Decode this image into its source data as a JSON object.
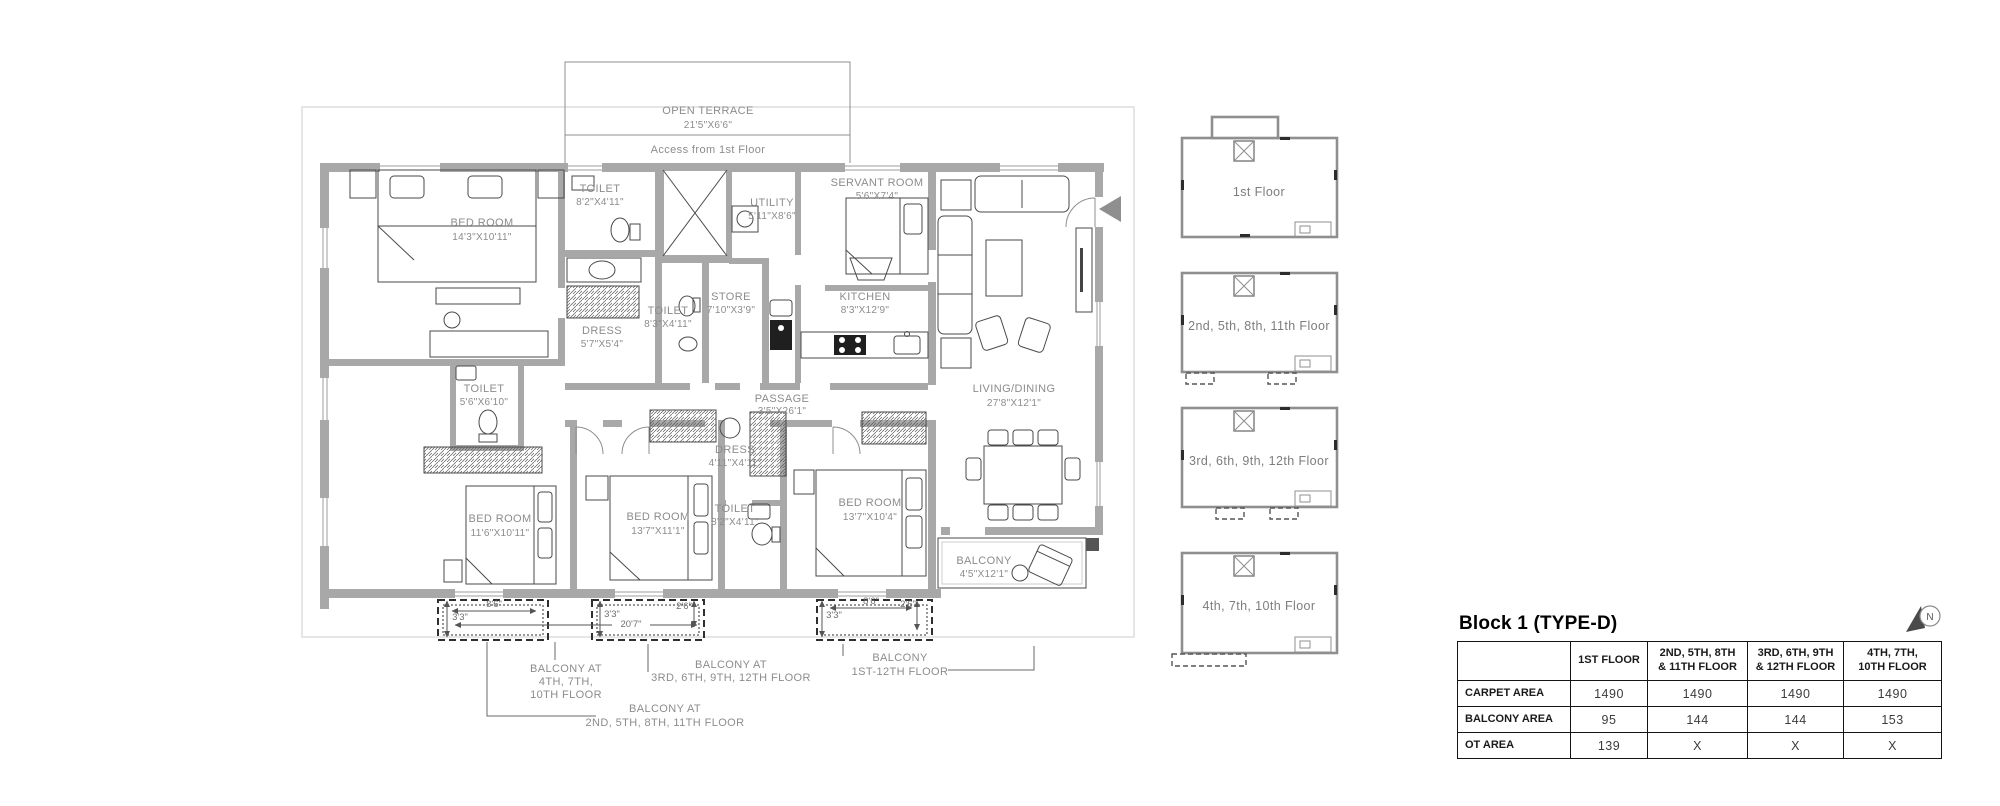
{
  "plan": {
    "open_terrace": {
      "name": "OPEN TERRACE",
      "size": "21'5\"X6'6\""
    },
    "access_note": "Access from 1st Floor",
    "rooms": {
      "bedroom1": {
        "name": "BED ROOM",
        "size": "14'3\"X10'11\""
      },
      "toilet_top": {
        "name": "TOILET",
        "size": "8'2\"X4'11\""
      },
      "utility": {
        "name": "UTILITY",
        "size": "5'11\"X8'6\""
      },
      "servant": {
        "name": "SERVANT ROOM",
        "size": "5'6\"X7'4\""
      },
      "store": {
        "name": "STORE",
        "size": "7'10\"X3'9\""
      },
      "toilet_mid": {
        "name": "TOILET",
        "size": "8'3\"X4'11\""
      },
      "kitchen": {
        "name": "KITCHEN",
        "size": "8'3\"X12'9\""
      },
      "dress1": {
        "name": "DRESS",
        "size": "5'7\"X5'4\""
      },
      "toilet_left": {
        "name": "TOILET",
        "size": "5'6\"X6'10\""
      },
      "passage": {
        "name": "PASSAGE",
        "size": "3'5\"X26'1\""
      },
      "living": {
        "name": "LIVING/DINING",
        "size": "27'8\"X12'1\""
      },
      "dress2": {
        "name": "DRESS",
        "size": "4'11\"X4'11\""
      },
      "toilet_bottom": {
        "name": "TOILET",
        "size": "8'2\"X4'11\""
      },
      "bedroom2": {
        "name": "BED ROOM",
        "size": "11'6\"X10'11\""
      },
      "bedroom3": {
        "name": "BED ROOM",
        "size": "13'7\"X11'1\""
      },
      "bedroom4": {
        "name": "BED ROOM",
        "size": "13'7\"X10'4\""
      },
      "balcony": {
        "name": "BALCONY",
        "size": "4'5\"X12'1\""
      }
    },
    "dims": {
      "b1_w": "8'6\"",
      "b1_d": "3'3\"",
      "b2_d": "3'3\"",
      "b2_w": "20'7\"",
      "b2_e": "2'6\"",
      "b3_w": "8'6\"",
      "b3_d": "3'3\"",
      "b3_e": "2'6\""
    },
    "notes": {
      "n1": {
        "l1": "BALCONY AT",
        "l2": "4TH, 7TH,",
        "l3": "10TH FLOOR"
      },
      "n2": {
        "l1": "BALCONY AT",
        "l2": "3RD, 6TH, 9TH, 12TH FLOOR"
      },
      "n3": {
        "l1": "BALCONY AT",
        "l2": "2ND, 5TH, 8TH, 11TH FLOOR"
      },
      "n4": {
        "l1": "BALCONY",
        "l2": "1ST-12TH FLOOR"
      }
    }
  },
  "key_plans": [
    {
      "label": "1st Floor"
    },
    {
      "label": "2nd, 5th, 8th, 11th Floor"
    },
    {
      "label": "3rd, 6th, 9th, 12th Floor"
    },
    {
      "label": "4th, 7th, 10th Floor"
    }
  ],
  "compass": {
    "label": "N"
  },
  "table": {
    "title": "Block 1 (TYPE-D)",
    "columns": [
      "1ST FLOOR",
      "2ND, 5TH, 8TH\n& 11TH FLOOR",
      "3RD, 6TH, 9TH\n& 12TH FLOOR",
      "4TH, 7TH,\n10TH FLOOR"
    ],
    "rows": [
      {
        "label": "CARPET AREA",
        "values": [
          "1490",
          "1490",
          "1490",
          "1490"
        ]
      },
      {
        "label": "BALCONY AREA",
        "values": [
          "95",
          "144",
          "144",
          "153"
        ]
      },
      {
        "label": "OT AREA",
        "values": [
          "139",
          "X",
          "X",
          "X"
        ]
      }
    ]
  },
  "colors": {
    "wall": "#a8a8a8",
    "label": "#8c8c8c",
    "line": "#4a4a4a"
  }
}
